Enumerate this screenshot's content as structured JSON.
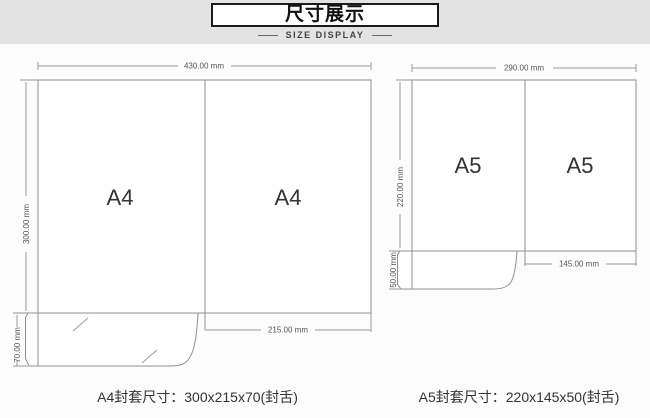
{
  "header": {
    "title_cn": "尺寸展示",
    "title_en": "SIZE DISPLAY"
  },
  "a4": {
    "panel_label": "A4",
    "total_width": "430.00 mm",
    "total_height": "300.00 mm",
    "pocket_height": "70.00 mm",
    "panel_width": "215.00 mm",
    "caption": "A4封套尺寸：300x215x70(封舌)"
  },
  "a5": {
    "panel_label": "A5",
    "total_width": "290.00 mm",
    "total_height": "220.00 mm",
    "pocket_height": "50.00 mm",
    "panel_width": "145.00 mm",
    "caption": "A5封套尺寸：220x145x50(封舌)"
  },
  "colors": {
    "band_bg": "#e3e3e3",
    "page_bg": "#fcfcfc",
    "outline": "#8f8f8f",
    "dimension_line": "#9a9a9a",
    "dimension_text": "#555555",
    "label_text": "#333333",
    "header_border": "#1b1b1b"
  }
}
